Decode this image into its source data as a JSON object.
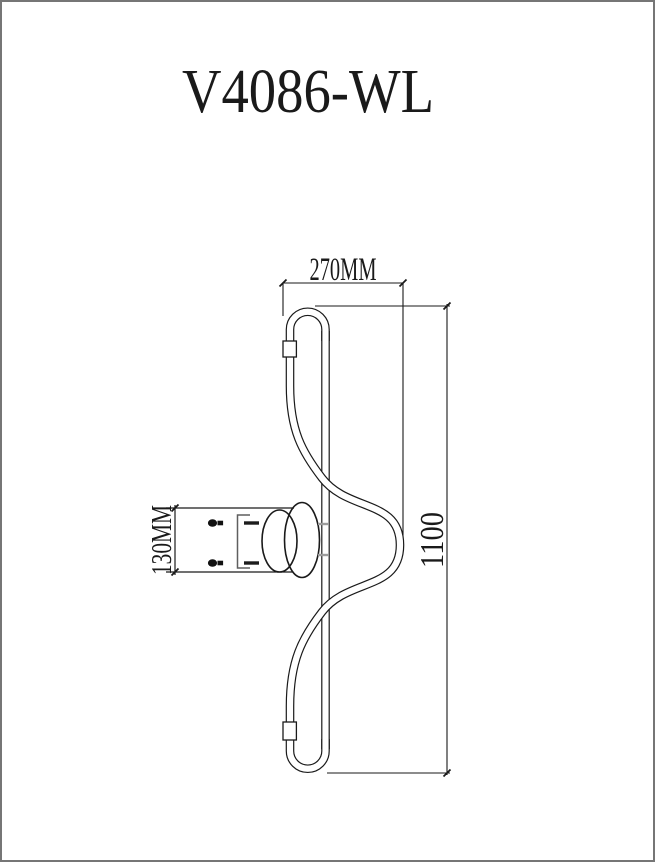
{
  "window": {
    "background": "#ffffff",
    "border_color": "#767676"
  },
  "title": {
    "text": "V4086-WL"
  },
  "drawing": {
    "subject": "wall-lamp-technical-line-drawing",
    "line_color": "#1a1a1a",
    "bracket_color": "#5f5f5f",
    "hidden_mark_color": "#9c9c9c",
    "dims": {
      "width": {
        "label": "270MM",
        "orientation": "horizontal"
      },
      "height": {
        "label": "1100",
        "orientation": "vertical"
      },
      "bracket": {
        "label": "130MM",
        "orientation": "vertical"
      }
    }
  }
}
